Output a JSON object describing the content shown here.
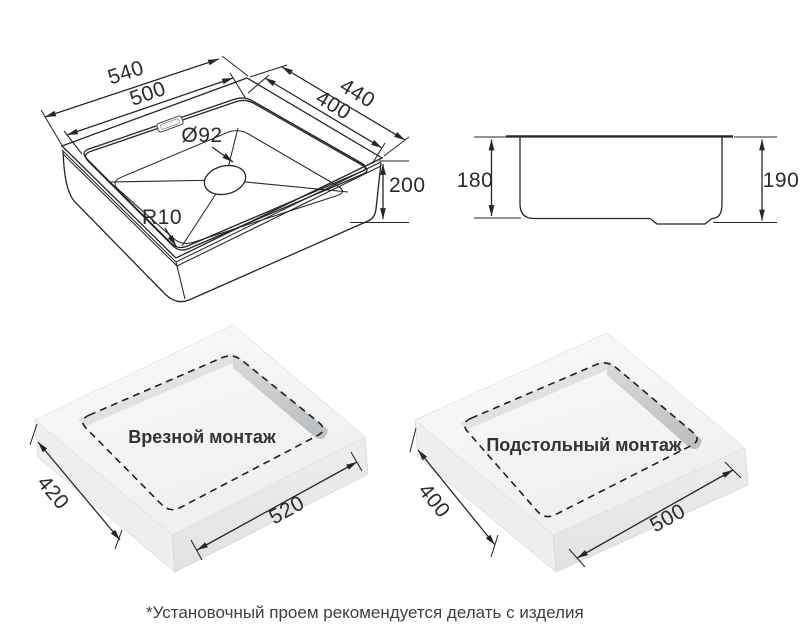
{
  "views": {
    "isometric": {
      "dims": {
        "outer_length": "540",
        "inner_length": "500",
        "outer_width": "440",
        "inner_width": "400",
        "drain_diameter": "Ø92",
        "depth": "200",
        "corner_radius": "R10"
      }
    },
    "side": {
      "dims": {
        "bowl_depth": "180",
        "overall_depth": "190"
      }
    },
    "inset_mount": {
      "label": "Врезной монтаж",
      "dims": {
        "cutout_width": "420",
        "cutout_length": "520"
      }
    },
    "under_mount": {
      "label": "Подстольный монтаж",
      "dims": {
        "cutout_width": "400",
        "cutout_length": "500"
      }
    }
  },
  "footnote": "*Установочный проем рекомендуется делать с изделия",
  "colors": {
    "line": "#262626",
    "text": "#2b2b2b",
    "slab_top": "#f6f6f6",
    "slab_side": "#ececec",
    "hole_wall": "#c3c6c8",
    "background": "#ffffff"
  }
}
